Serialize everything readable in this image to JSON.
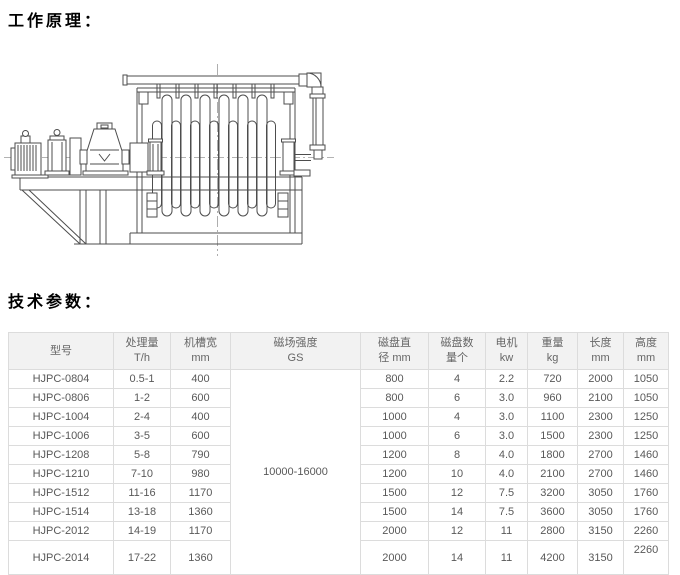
{
  "sections": {
    "working_principle_label": "工作原理：",
    "tech_params_label": "技术参数："
  },
  "drawing": {
    "name": "disk-magnetic-separator-side-elevation"
  },
  "colors": {
    "header_bg": "#f2f2f2",
    "table_border": "#dcdcdc",
    "table_text": "#595959",
    "line_color": "#4d4d4d"
  },
  "table": {
    "columns": [
      {
        "line1": "型号",
        "line2": ""
      },
      {
        "line1": "处理量",
        "line2": "T/h"
      },
      {
        "line1": "机槽宽",
        "line2": "mm"
      },
      {
        "line1": "磁场强度",
        "line2": "GS"
      },
      {
        "line1": "磁盘直",
        "line2": "径 mm"
      },
      {
        "line1": "磁盘数",
        "line2": "量个"
      },
      {
        "line1": "电机",
        "line2": "kw"
      },
      {
        "line1": "重量",
        "line2": "kg"
      },
      {
        "line1": "长度",
        "line2": "mm"
      },
      {
        "line1": "高度",
        "line2": "mm"
      }
    ],
    "gauss_value": "10000-16000",
    "rows": [
      [
        "HJPC-0804",
        "0.5-1",
        "400",
        "800",
        "4",
        "2.2",
        "720",
        "2000",
        "1050"
      ],
      [
        "HJPC-0806",
        "1-2",
        "600",
        "800",
        "6",
        "3.0",
        "960",
        "2100",
        "1050"
      ],
      [
        "HJPC-1004",
        "2-4",
        "400",
        "1000",
        "4",
        "3.0",
        "1100",
        "2300",
        "1250"
      ],
      [
        "HJPC-1006",
        "3-5",
        "600",
        "1000",
        "6",
        "3.0",
        "1500",
        "2300",
        "1250"
      ],
      [
        "HJPC-1208",
        "5-8",
        "790",
        "1200",
        "8",
        "4.0",
        "1800",
        "2700",
        "1460"
      ],
      [
        "HJPC-1210",
        "7-10",
        "980",
        "1200",
        "10",
        "4.0",
        "2100",
        "2700",
        "1460"
      ],
      [
        "HJPC-1512",
        "11-16",
        "1170",
        "1500",
        "12",
        "7.5",
        "3200",
        "3050",
        "1760"
      ],
      [
        "HJPC-1514",
        "13-18",
        "1360",
        "1500",
        "14",
        "7.5",
        "3600",
        "3050",
        "1760"
      ],
      [
        "HJPC-2012",
        "14-19",
        "1170",
        "2000",
        "12",
        "11",
        "2800",
        "3150",
        "2260"
      ],
      [
        "HJPC-2014",
        "17-22",
        "1360",
        "2000",
        "14",
        "11",
        "4200",
        "3150",
        "2260"
      ]
    ]
  }
}
